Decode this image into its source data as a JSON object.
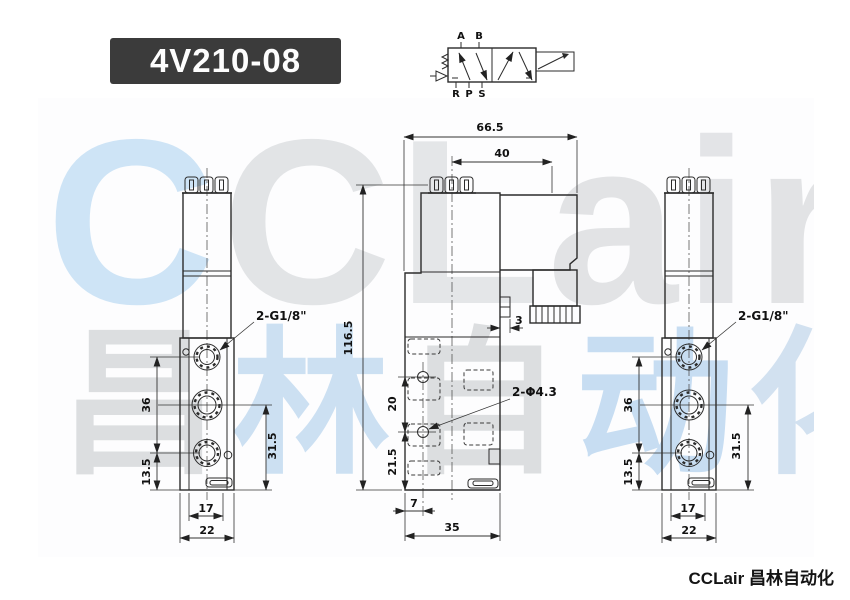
{
  "title": "4V210-08",
  "watermark": {
    "row1": "CCLair",
    "row1_colors": [
      "#8fc4ec",
      "#bfc3c7",
      "#c3c7ca",
      "#bdc1c5",
      "#c0c4c8",
      "#bdc1c5"
    ],
    "row2": "昌林自动化",
    "row2_colors": [
      "#bcc0c4",
      "#9dc4e8",
      "#bcc0c4",
      "#93bfe8",
      "#a8c6e4"
    ]
  },
  "symbol": {
    "top_ports": [
      "A",
      "B"
    ],
    "bottom_ports": [
      "R",
      "P",
      "S"
    ]
  },
  "views": {
    "front_left": {
      "thread_label": "2-G1/8\"",
      "d36": "36",
      "d135": "13.5",
      "d315": "31.5",
      "d17": "17",
      "d22": "22"
    },
    "side": {
      "d665": "66.5",
      "d40": "40",
      "d1165": "116.5",
      "d20": "20",
      "d215": "21.5",
      "d7": "7",
      "d35": "35",
      "d3": "3",
      "hole_label": "2-Φ4.3"
    },
    "front_right": {
      "thread_label": "2-G1/8\"",
      "d36": "36",
      "d135": "13.5",
      "d315": "31.5",
      "d17": "17",
      "d22": "22"
    }
  },
  "footer": {
    "brand": "CCLair 昌林自动化"
  }
}
